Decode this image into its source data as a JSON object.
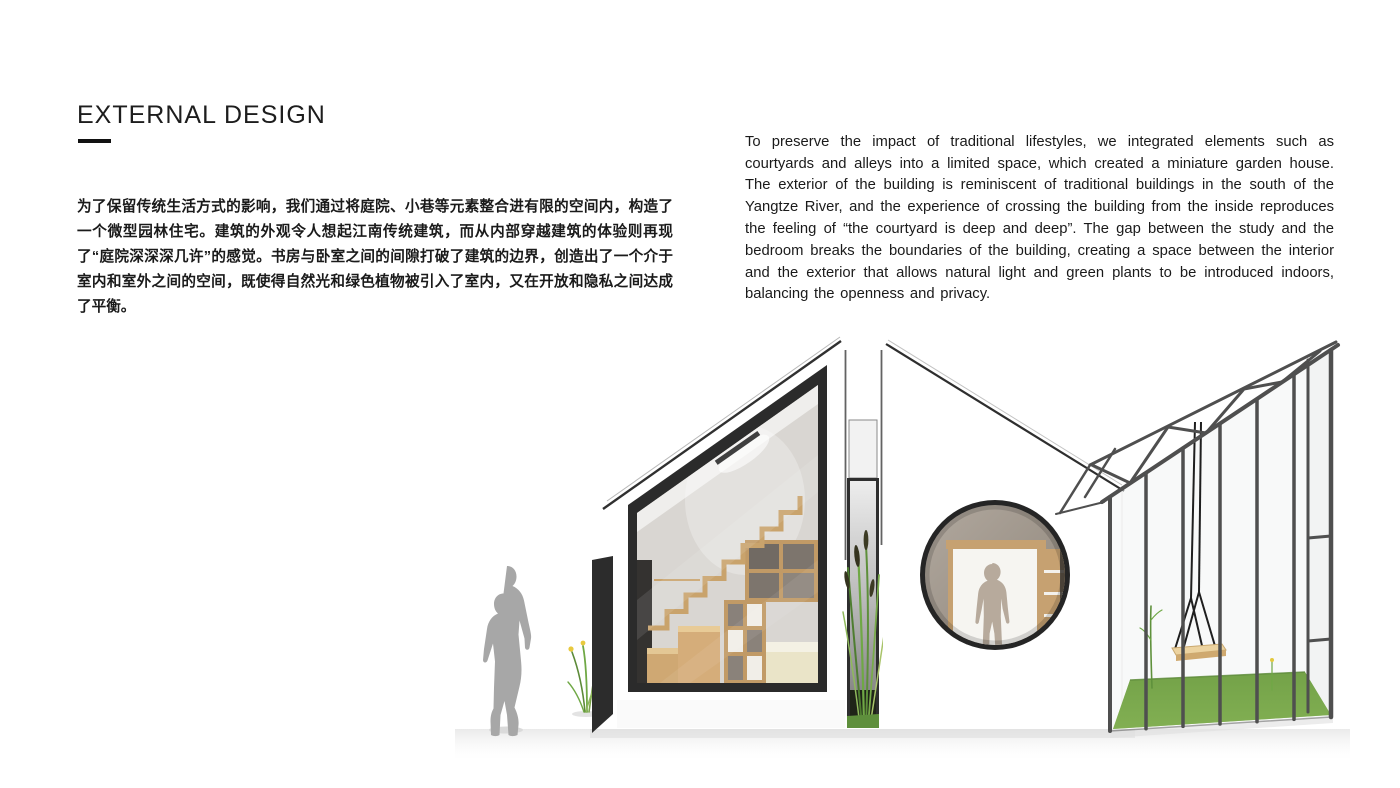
{
  "page": {
    "title": "EXTERNAL DESIGN",
    "background_color": "#ffffff",
    "text_color": "#1a1a1a"
  },
  "paragraphs": {
    "chinese": "为了保留传统生活方式的影响，我们通过将庭院、小巷等元素整合进有限的空间内，构造了一个微型园林住宅。建筑的外观令人想起江南传统建筑，而从内部穿越建筑的体验则再现了“庭院深深深几许”的感觉。书房与卧室之间的间隙打破了建筑的边界，创造出了一个介于室内和室外之间的空间，既使得自然光和绿色植物被引入了室内，又在开放和隐私之间达成了平衡。",
    "english": "To preserve the impact of traditional lifestyles, we integrated elements such as courtyards and alleys into a limited space, which created a miniature garden house. The exterior of the building is reminiscent of traditional buildings in the south of the Yangtze River, and the experience of crossing the building from the inside reproduces the feeling of “the courtyard is deep and deep”. The gap between the study and the bedroom breaks the boundaries of the building, creating a space between the interior and the exterior that allows natural light and green plants to be introduced indoors, balancing the openness and privacy."
  },
  "illustration": {
    "description": "Rendering of a miniature garden house: a study volume with a large gable window and staircase, a narrow planted courtyard gap, a bedroom volume with a round window, and a steel-framed glasshouse with a swing on a grass floor; a walking figure gives scale.",
    "colors": {
      "silhouette_gray": "#a7a7a7",
      "frame_dark": "#2b2b2b",
      "round_rim_dark": "#252525",
      "stair_wood": "#c9a36c",
      "wood_light": "#e3c795",
      "bed_cream": "#eae4c8",
      "steel_gray": "#4f4f4f",
      "grass_green": "#7dab4e",
      "slot_grass_green": "#5e8f3c",
      "plant_green": "#6fa845",
      "swing_seat_wood": "#ecd3a0",
      "interior_warm_gray": "#9a9086",
      "flower_yellow": "#e8c93e"
    }
  }
}
